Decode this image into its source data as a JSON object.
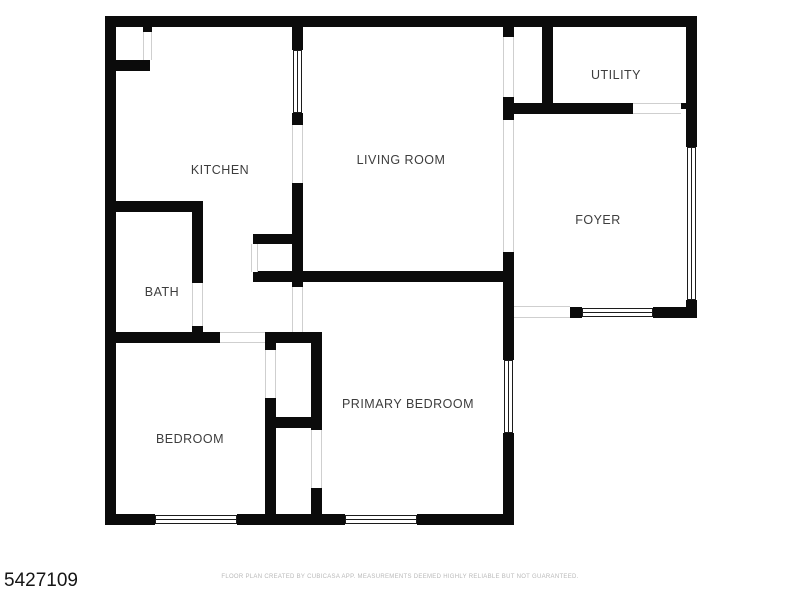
{
  "page": {
    "id_number": "5427109",
    "disclaimer": "FLOOR PLAN CREATED BY CUBICASA APP. MEASUREMENTS DEEMED HIGHLY RELIABLE BUT NOT GUARANTEED."
  },
  "floorplan": {
    "wall_color": "#0b0b0b",
    "opening_line_color": "#cfcfcf",
    "window_line_color": "#1c1c1c",
    "rooms": [
      {
        "name": "kitchen",
        "label": "KITCHEN",
        "cx": 220,
        "cy": 170
      },
      {
        "name": "living-room",
        "label": "LIVING ROOM",
        "cx": 401,
        "cy": 160
      },
      {
        "name": "utility",
        "label": "UTILITY",
        "cx": 616,
        "cy": 75
      },
      {
        "name": "foyer",
        "label": "FOYER",
        "cx": 598,
        "cy": 220
      },
      {
        "name": "bath",
        "label": "BATH",
        "cx": 162,
        "cy": 292
      },
      {
        "name": "bedroom",
        "label": "BEDROOM",
        "cx": 190,
        "cy": 439
      },
      {
        "name": "primary-bedroom",
        "label": "PRIMARY BEDROOM",
        "cx": 408,
        "cy": 404
      }
    ],
    "walls": [
      {
        "x": 105,
        "y": 16,
        "w": 592,
        "h": 11
      },
      {
        "x": 105,
        "y": 16,
        "w": 11,
        "h": 509
      },
      {
        "x": 105,
        "y": 514,
        "w": 50,
        "h": 11
      },
      {
        "x": 237,
        "y": 514,
        "w": 108,
        "h": 11
      },
      {
        "x": 417,
        "y": 514,
        "w": 97,
        "h": 11
      },
      {
        "x": 686,
        "y": 16,
        "w": 11,
        "h": 131
      },
      {
        "x": 686,
        "y": 300,
        "w": 11,
        "h": 18
      },
      {
        "x": 570,
        "y": 307,
        "w": 12,
        "h": 11
      },
      {
        "x": 653,
        "y": 307,
        "w": 44,
        "h": 11
      },
      {
        "x": 503,
        "y": 103,
        "w": 130,
        "h": 11
      },
      {
        "x": 681,
        "y": 103,
        "w": 5,
        "h": 6
      },
      {
        "x": 542,
        "y": 27,
        "w": 11,
        "h": 87
      },
      {
        "x": 503,
        "y": 27,
        "w": 11,
        "h": 10
      },
      {
        "x": 503,
        "y": 97,
        "w": 11,
        "h": 23
      },
      {
        "x": 503,
        "y": 252,
        "w": 11,
        "h": 108
      },
      {
        "x": 503,
        "y": 433,
        "w": 11,
        "h": 92
      },
      {
        "x": 514,
        "y": 306,
        "w": 5,
        "h": 12
      },
      {
        "x": 292,
        "y": 27,
        "w": 11,
        "h": 23
      },
      {
        "x": 292,
        "y": 113,
        "w": 11,
        "h": 12
      },
      {
        "x": 292,
        "y": 183,
        "w": 11,
        "h": 104
      },
      {
        "x": 116,
        "y": 60,
        "w": 34,
        "h": 11
      },
      {
        "x": 143,
        "y": 27,
        "w": 9,
        "h": 5
      },
      {
        "x": 116,
        "y": 201,
        "w": 87,
        "h": 11
      },
      {
        "x": 192,
        "y": 212,
        "w": 11,
        "h": 71
      },
      {
        "x": 192,
        "y": 326,
        "w": 11,
        "h": 6
      },
      {
        "x": 253,
        "y": 234,
        "w": 50,
        "h": 10
      },
      {
        "x": 253,
        "y": 271,
        "w": 261,
        "h": 11
      },
      {
        "x": 105,
        "y": 332,
        "w": 115,
        "h": 11
      },
      {
        "x": 265,
        "y": 332,
        "w": 57,
        "h": 11
      },
      {
        "x": 292,
        "y": 326,
        "w": 11,
        "h": 6
      },
      {
        "x": 265,
        "y": 332,
        "w": 11,
        "h": 18
      },
      {
        "x": 265,
        "y": 398,
        "w": 11,
        "h": 127
      },
      {
        "x": 311,
        "y": 332,
        "w": 11,
        "h": 98
      },
      {
        "x": 311,
        "y": 488,
        "w": 11,
        "h": 37
      },
      {
        "x": 265,
        "y": 417,
        "w": 57,
        "h": 11
      }
    ],
    "windows": [
      {
        "x": 293,
        "y": 50,
        "w": 9,
        "h": 63,
        "dir": "v"
      },
      {
        "x": 687,
        "y": 147,
        "w": 9,
        "h": 153,
        "dir": "v"
      },
      {
        "x": 504,
        "y": 360,
        "w": 9,
        "h": 73,
        "dir": "v"
      },
      {
        "x": 582,
        "y": 308,
        "w": 71,
        "h": 9,
        "dir": "h"
      },
      {
        "x": 155,
        "y": 515,
        "w": 82,
        "h": 9,
        "dir": "h"
      },
      {
        "x": 345,
        "y": 515,
        "w": 72,
        "h": 9,
        "dir": "h"
      }
    ],
    "openings": [
      {
        "x": 143,
        "y": 32,
        "w": 9,
        "h": 28,
        "dir": "v"
      },
      {
        "x": 292,
        "y": 125,
        "w": 11,
        "h": 58,
        "dir": "v"
      },
      {
        "x": 503,
        "y": 37,
        "w": 11,
        "h": 60,
        "dir": "v"
      },
      {
        "x": 503,
        "y": 120,
        "w": 11,
        "h": 132,
        "dir": "v"
      },
      {
        "x": 633,
        "y": 103,
        "w": 48,
        "h": 11,
        "dir": "h"
      },
      {
        "x": 514,
        "y": 306,
        "w": 56,
        "h": 12,
        "dir": "h"
      },
      {
        "x": 192,
        "y": 283,
        "w": 11,
        "h": 43,
        "dir": "v"
      },
      {
        "x": 220,
        "y": 332,
        "w": 45,
        "h": 11,
        "dir": "h"
      },
      {
        "x": 265,
        "y": 350,
        "w": 11,
        "h": 48,
        "dir": "v"
      },
      {
        "x": 311,
        "y": 430,
        "w": 11,
        "h": 58,
        "dir": "v"
      },
      {
        "x": 251,
        "y": 244,
        "w": 7,
        "h": 28,
        "dir": "v"
      },
      {
        "x": 292,
        "y": 287,
        "w": 11,
        "h": 45,
        "dir": "v"
      }
    ]
  }
}
